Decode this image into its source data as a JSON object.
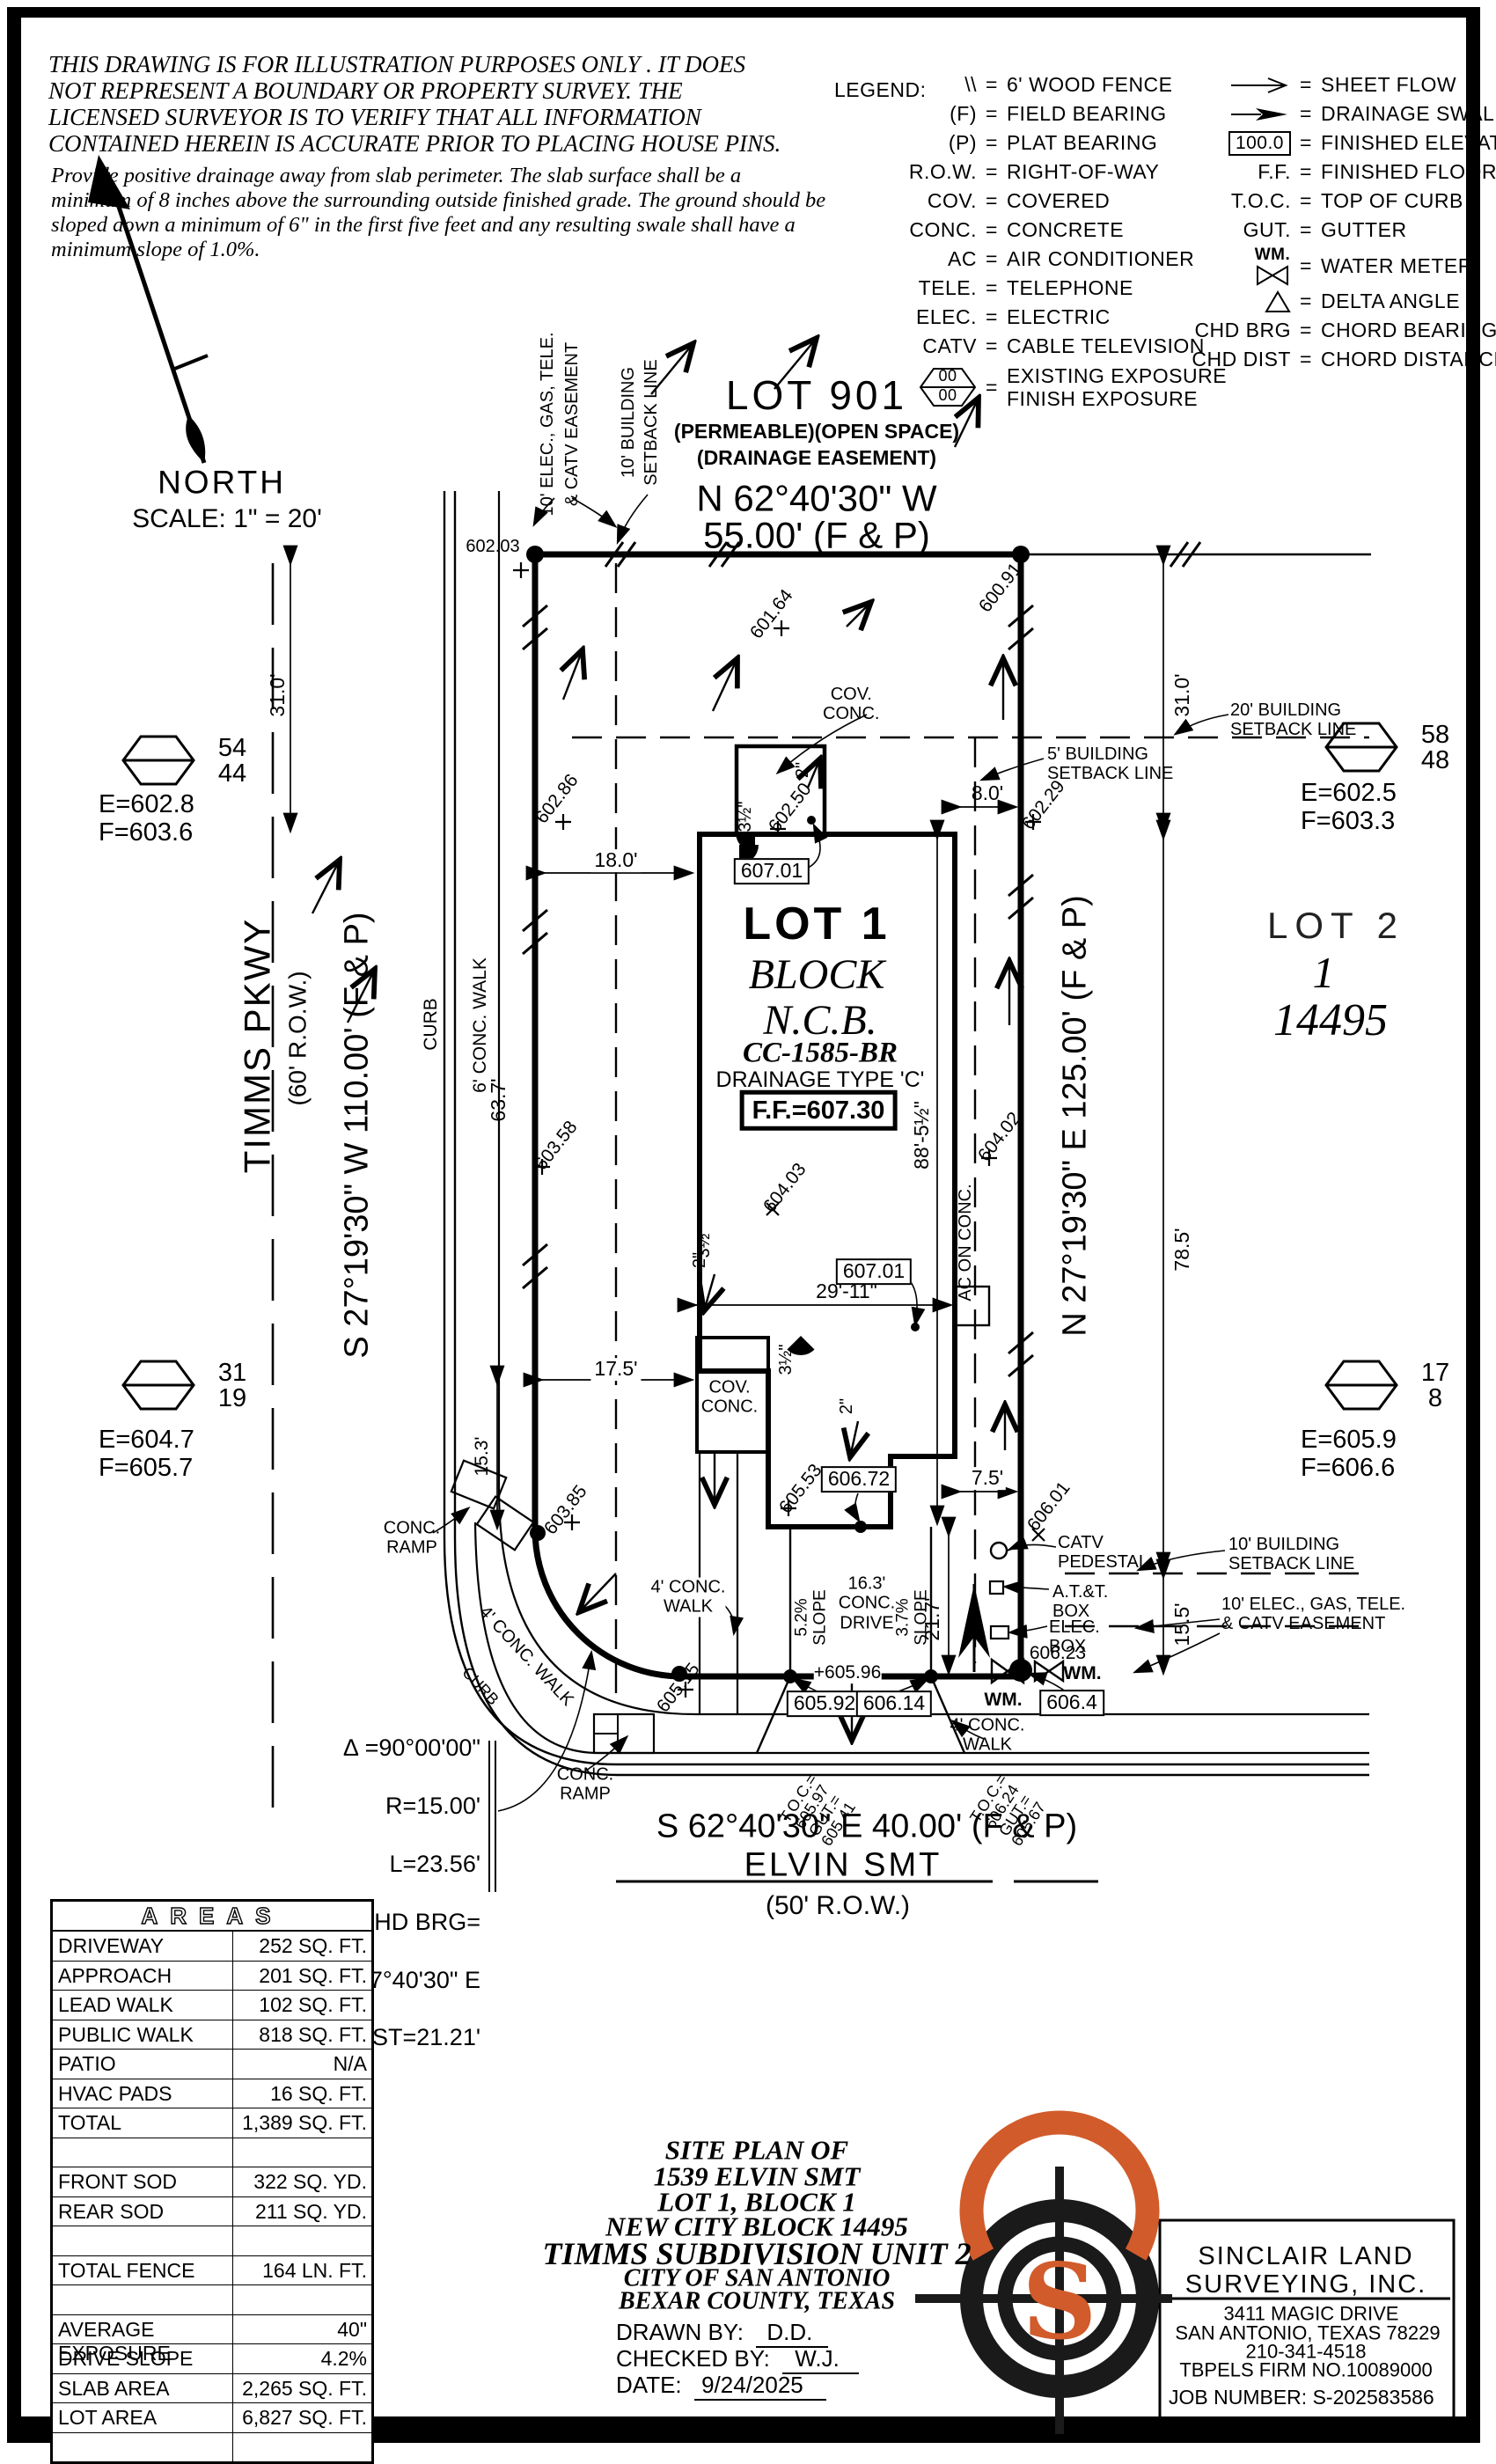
{
  "colors": {
    "ink": "#000000",
    "accent_orange": "#d15b2b",
    "paper": "#ffffff"
  },
  "disclaimer": {
    "l1": "THIS DRAWING IS FOR ILLUSTRATION PURPOSES ONLY . IT DOES",
    "l2": "NOT REPRESENT A BOUNDARY OR PROPERTY SURVEY. THE",
    "l3": "LICENSED SURVEYOR IS TO VERIFY THAT ALL INFORMATION",
    "l4": "CONTAINED HEREIN IS ACCURATE PRIOR TO PLACING HOUSE PINS.",
    "p1": "Provide positive drainage away from slab perimeter. The slab surface shall be a",
    "p2": "minimum of 8 inches above the surrounding outside finished grade. The ground should be",
    "p3": "sloped down a minimum of 6\" in the first five feet and any resulting swale shall have a",
    "p4": "minimum slope of 1.0%."
  },
  "legend": {
    "title": "LEGEND:",
    "left": [
      {
        "icon": "wood-fence-icon",
        "symbol": "\\\\",
        "definition": "6' WOOD FENCE"
      },
      {
        "symbol": "(F)",
        "definition": "FIELD BEARING"
      },
      {
        "symbol": "(P)",
        "definition": "PLAT BEARING"
      },
      {
        "symbol": "R.O.W.",
        "definition": "RIGHT-OF-WAY"
      },
      {
        "symbol": "COV.",
        "definition": "COVERED"
      },
      {
        "symbol": "CONC.",
        "definition": "CONCRETE"
      },
      {
        "symbol": "AC",
        "definition": "AIR CONDITIONER"
      },
      {
        "symbol": "TELE.",
        "definition": "TELEPHONE"
      },
      {
        "symbol": "ELEC.",
        "definition": "ELECTRIC"
      },
      {
        "symbol": "CATV",
        "definition": "CABLE TELEVISION"
      },
      {
        "icon": "exposure-hexagon-icon",
        "symbol": "00/00",
        "definition": "EXISTING EXPOSURE\nFINISH EXPOSURE"
      }
    ],
    "right": [
      {
        "icon": "sheet-flow-arrow-icon",
        "definition": "SHEET FLOW"
      },
      {
        "icon": "drainage-swale-arrow-icon",
        "definition": "DRAINAGE SWALE"
      },
      {
        "icon": "finished-elevation-box-icon",
        "symbol": "100.0",
        "definition": "FINISHED ELEVATION"
      },
      {
        "symbol": "F.F.",
        "definition": "FINISHED FLOOR"
      },
      {
        "symbol": "T.O.C.",
        "definition": "TOP OF CURB"
      },
      {
        "symbol": "GUT.",
        "definition": "GUTTER"
      },
      {
        "icon": "water-meter-icon",
        "symbol": "WM.",
        "definition": "WATER METER"
      },
      {
        "icon": "delta-angle-icon",
        "definition": "DELTA ANGLE"
      },
      {
        "symbol": "CHD BRG",
        "definition": "CHORD BEARING"
      },
      {
        "symbol": "CHD DIST",
        "definition": "CHORD DISTANCE"
      }
    ]
  },
  "north": {
    "label": "NORTH",
    "scale": "SCALE: 1\" = 20'"
  },
  "lot901": {
    "name": "LOT 901",
    "note1": "(PERMEABLE)(OPEN SPACE)",
    "note2": "(DRAINAGE EASEMENT)",
    "bearing": "N 62°40'30\" W",
    "distance": "55.00' (F & P)"
  },
  "streets": {
    "timms": {
      "name": "TIMMS PKWY",
      "row": "(60' R.O.W.)",
      "bearing": "S 27°19'30\" W 110.00' (F & P)",
      "curb": "CURB",
      "walk": "6' CONC. WALK",
      "walk_dim": "63.7'"
    },
    "elvin": {
      "name": "ELVIN SMT",
      "row": "(50' R.O.W.)",
      "bearing": "S 62°40'30\" E 40.00' (F & P)"
    },
    "east_bearing": "N 27°19'30\" E 125.00' (F & P)"
  },
  "lot1": {
    "lot": "LOT 1",
    "block_label": "BLOCK",
    "ncb": "N.C.B.",
    "cc": "CC-1585-BR",
    "drainage": "DRAINAGE TYPE 'C'",
    "ff": "F.F.=607.30"
  },
  "lot2": {
    "name": "LOT 2",
    "block_number": "1",
    "ncb_number": "14495"
  },
  "hexagons": [
    {
      "top": "54",
      "bottom": "44",
      "e": "E=602.8",
      "f": "F=603.6"
    },
    {
      "top": "58",
      "bottom": "48",
      "e": "E=602.5",
      "f": "F=603.3"
    },
    {
      "top": "31",
      "bottom": "19",
      "e": "E=604.7",
      "f": "F=605.7"
    },
    {
      "top": "17",
      "bottom": "8",
      "e": "E=605.9",
      "f": "F=606.6"
    }
  ],
  "dims": {
    "d31l": "31.0'",
    "d31r": "31.0'",
    "d78": "78.5'",
    "d15_5": "15.5'",
    "d88": "88'-5½\"",
    "d63": "63.7'",
    "d15_3": "15.3'",
    "d17_5": "17.5'",
    "d18": "18.0'",
    "d8": "8.0'",
    "d29": "29'-11\"",
    "d7_5": "7.5'",
    "d21_7": "21.7'",
    "t35a": "3½\"",
    "t35b": "3½\"",
    "t35c": "3½\"",
    "t2a": "2\"",
    "t2b": "2\"",
    "t2c": "2\""
  },
  "spots": {
    "s60203": "602.03",
    "s60286": "602.86",
    "s60358": "603.58",
    "s60164": "601.64",
    "s60091": "600.91",
    "s60229": "602.29",
    "s60250": "602.50",
    "s60402": "604.02",
    "s60403": "604.03",
    "s60553": "605.53",
    "s60601": "606.01",
    "s60385": "603.85",
    "s60515": "605.15",
    "s60596": "+605.96",
    "s60623": "606.23"
  },
  "boxes": {
    "b60701a": "607.01",
    "b60701b": "607.01",
    "b60672": "606.72",
    "b60592": "605.92",
    "b60614": "606.14",
    "b6064": "606.4"
  },
  "labels": {
    "cov_top": "COV.\nCONC.",
    "cov_left": "COV.\nCONC.",
    "ac": "AC ON CONC.",
    "ramp_left": "CONC.\nRAMP",
    "ramp_bottom": "CONC.\nRAMP",
    "walk_curve": "4' CONC. WALK",
    "walk_mid": "4' CONC.\nWALK",
    "walk_right": "4' CONC.\nWALK",
    "curb_bottom": "CURB",
    "drive": "16.3'\nCONC.\nDRIVE",
    "slope_l": "5.2%\nSLOPE",
    "slope_r": "3.7%\nSLOPE",
    "catv": "CATV\nPEDESTAL",
    "att": "A.T.&T.\nBOX",
    "elec": "ELEC.\nBOX",
    "wm_l": "WM.",
    "wm_r": "WM."
  },
  "toc": {
    "left": "T.O.C.=\n605.97\nGUT.=\n605.41",
    "right": "T.O.C.=\n606.24\nGUT.=\n605.67"
  },
  "easements": {
    "e_w1": "10' ELEC., GAS, TELE.",
    "e_w2": "& CATV EASEMENT",
    "sb_w1": "10' BUILDING",
    "sb_w2": "SETBACK LINE",
    "sb5": "5' BUILDING\nSETBACK LINE",
    "sb20": "20' BUILDING\nSETBACK LINE",
    "sb10s": "10' BUILDING\nSETBACK LINE",
    "e_s": "10' ELEC., GAS, TELE.\n& CATV EASEMENT"
  },
  "curve": {
    "delta": "∆ =90°00'00\"",
    "r": "R=15.00'",
    "l": "L=23.56'",
    "brg_label": "CHD BRG=",
    "brg": "S 17°40'30\" E",
    "dist": "CHD DIST=21.21'"
  },
  "areas": {
    "title": "AREAS",
    "rows": [
      {
        "label": "DRIVEWAY",
        "value": "252 SQ. FT."
      },
      {
        "label": "APPROACH",
        "value": "201 SQ. FT."
      },
      {
        "label": "LEAD WALK",
        "value": "102 SQ. FT."
      },
      {
        "label": "PUBLIC WALK",
        "value": "818 SQ. FT."
      },
      {
        "label": "PATIO",
        "value": "N/A"
      },
      {
        "label": "HVAC PADS",
        "value": "16 SQ. FT."
      },
      {
        "label": "TOTAL",
        "value": "1,389 SQ. FT."
      },
      {
        "label": "",
        "value": ""
      },
      {
        "label": "FRONT SOD",
        "value": "322 SQ. YD."
      },
      {
        "label": "REAR SOD",
        "value": "211 SQ. YD."
      },
      {
        "label": "",
        "value": ""
      },
      {
        "label": "TOTAL FENCE",
        "value": "164 LN. FT."
      },
      {
        "label": "",
        "value": ""
      },
      {
        "label": "AVERAGE EXPOSURE",
        "value": "40\""
      },
      {
        "label": "DRIVE SLOPE",
        "value": "4.2%"
      },
      {
        "label": "SLAB AREA",
        "value": "2,265 SQ. FT."
      },
      {
        "label": "LOT AREA",
        "value": "6,827 SQ. FT."
      },
      {
        "label": "",
        "value": ""
      }
    ]
  },
  "tb": {
    "l1": "SITE PLAN OF",
    "l2": "1539 ELVIN SMT",
    "l3": "LOT 1, BLOCK 1",
    "l4": "NEW CITY BLOCK 14495",
    "l5": "TIMMS SUBDIVISION UNIT 2",
    "l6": "CITY OF SAN ANTONIO",
    "l7": "BEXAR COUNTY, TEXAS",
    "drawn_label": "DRAWN BY:",
    "drawn": "D.D.",
    "checked_label": "CHECKED BY:",
    "checked": "W.J.",
    "date_label": "DATE:",
    "date": "9/24/2025"
  },
  "surv": {
    "name1": "SINCLAIR LAND",
    "name2": "SURVEYING, INC.",
    "addr": "3411 MAGIC DRIVE",
    "city": "SAN ANTONIO, TEXAS 78229",
    "phone": "210-341-4518",
    "firm": "TBPELS FIRM NO.10089000",
    "job": "JOB NUMBER: S-202583586",
    "letter": "S"
  }
}
